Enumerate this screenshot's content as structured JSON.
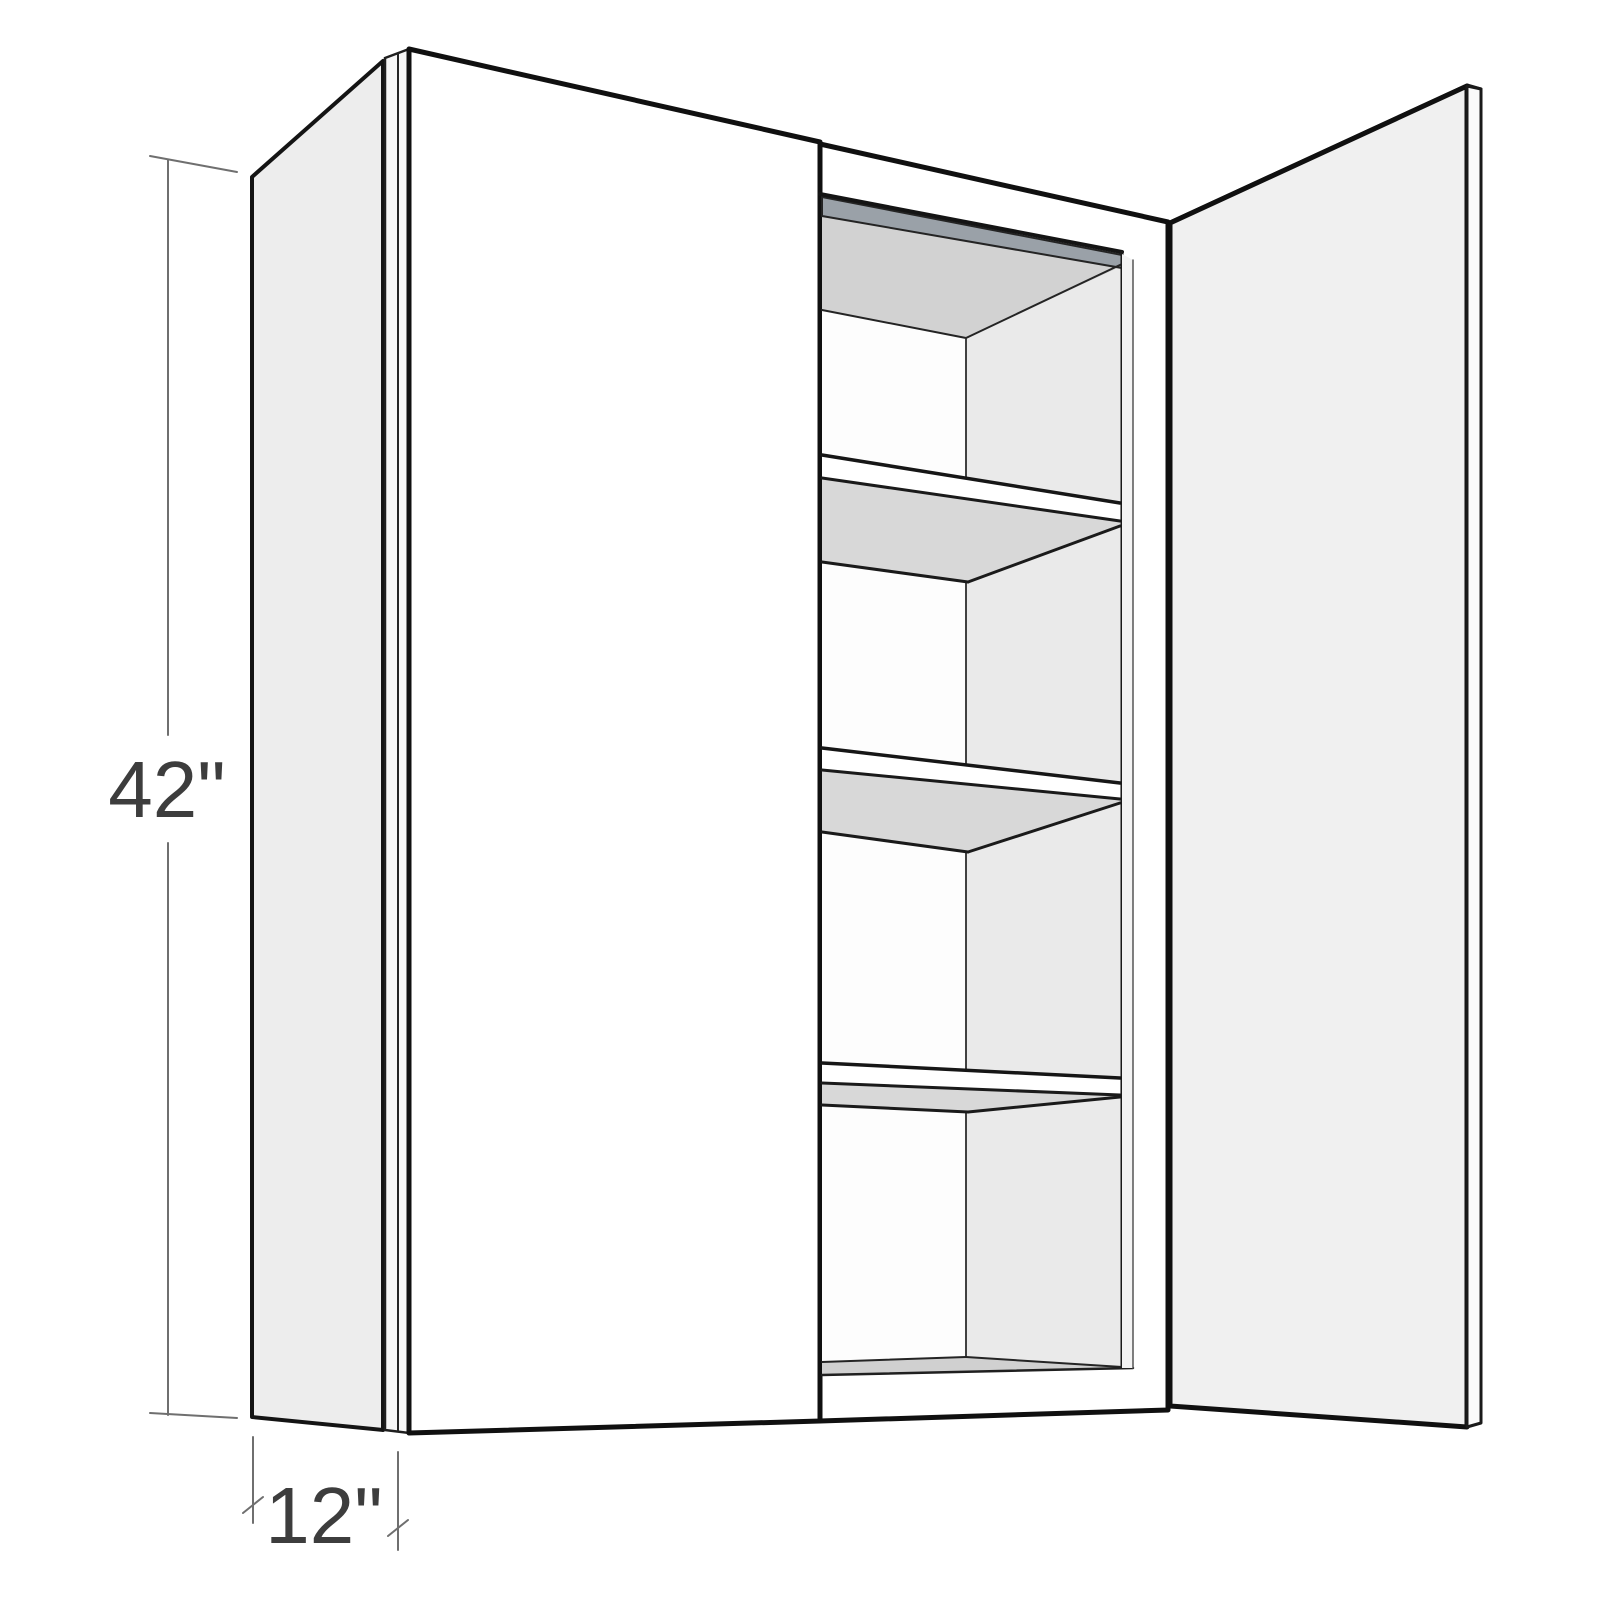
{
  "figure": {
    "subject": "two-door wall cabinet with right door open",
    "visible_shelves": 3,
    "height_inches": 42,
    "depth_inches": 12
  },
  "dimensions": {
    "height_label": "42\"",
    "depth_label": "12\""
  },
  "colors": {
    "background": "#ffffff",
    "dim_text": "#3d3d3d",
    "side_panel": "#ededed",
    "door_face": "#ffffff",
    "door_edge": "#f6f6f6",
    "open_door_face": "#f0f0f0",
    "open_door_edge": "#fafafa",
    "interior_ceiling": "#d2d2d2",
    "interior_left_wall": "#fdfdfd",
    "interior_back_wall": "#eaeaea",
    "right_return": "#f3f3f3",
    "hang_rail": "#9aa1a8",
    "shelf_face": "#ffffff",
    "shelf_underside": "#d8d8d8",
    "bottom_surface": "#d0d0d0"
  }
}
